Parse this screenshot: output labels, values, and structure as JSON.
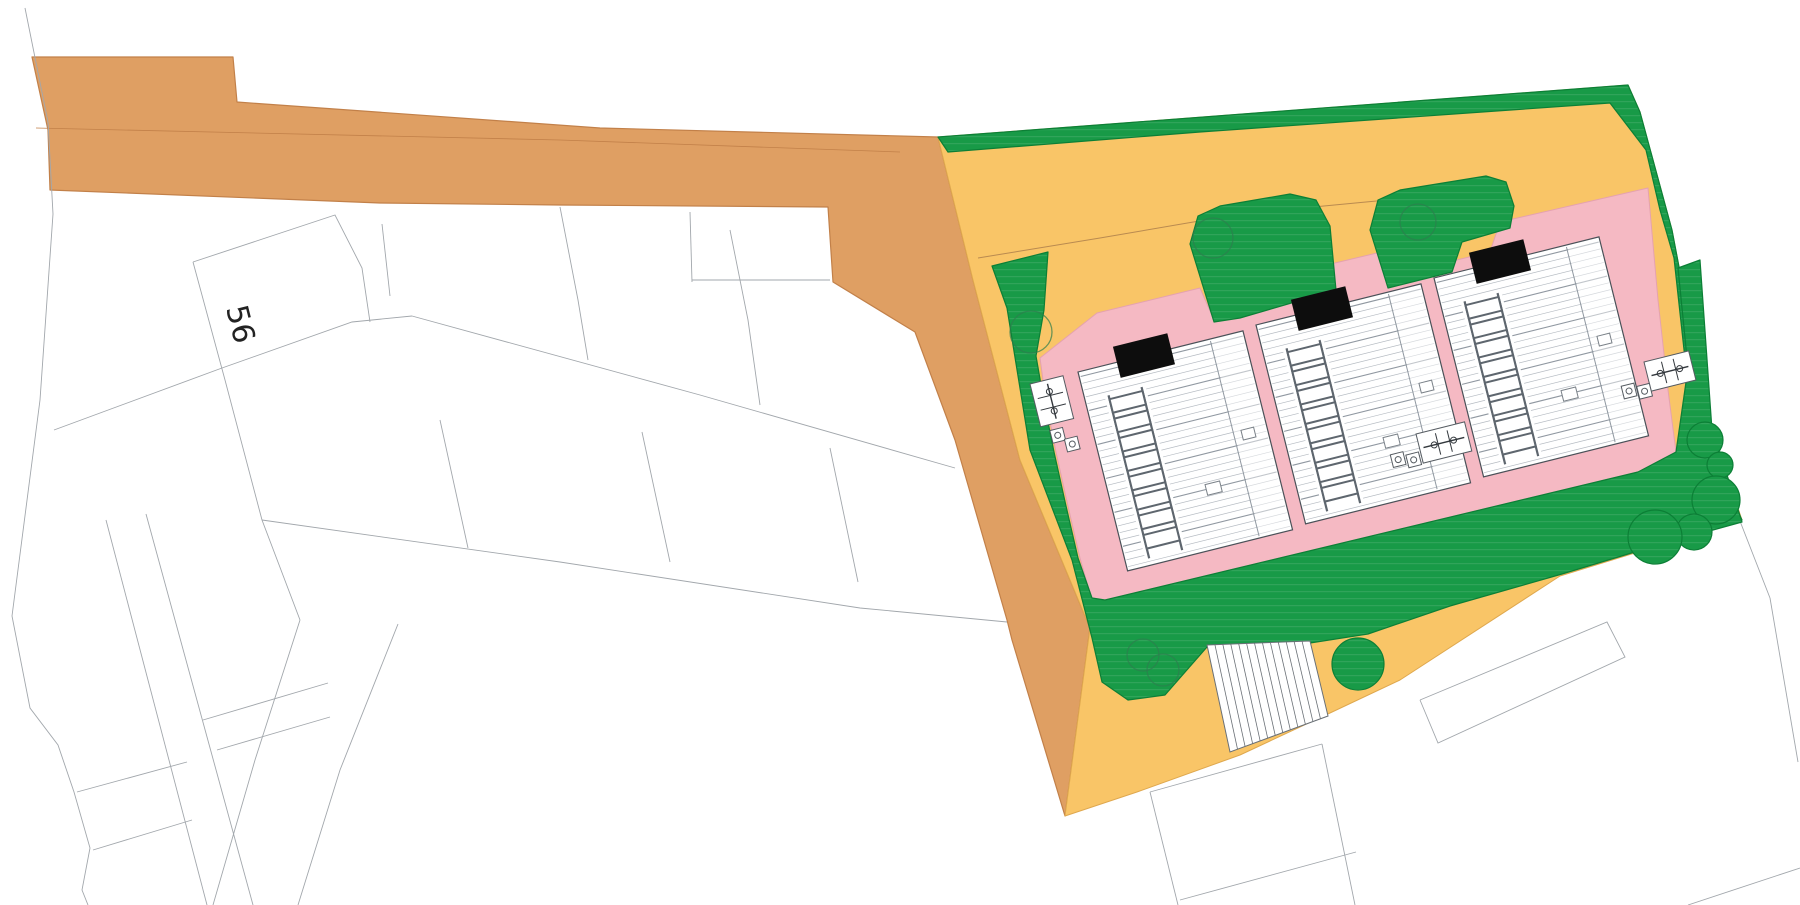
{
  "title": "architectural site plan drawing",
  "labels": {
    "plot_number": "56"
  },
  "palette": {
    "white": "#FFFFFF",
    "road": "#DF9F63",
    "road_edge": "#C28049",
    "yellow": "#F9C567",
    "yellow_edge": "#DFA84E",
    "green": "#189A47",
    "green_edge": "#0C7F36",
    "pink": "#F5B9C3",
    "pink_edge": "#E5A2AF",
    "line": "#A2A7AC",
    "black": "#0D0D0D",
    "roof_edge": "#4A5158",
    "roof_line": "#B5BBC2",
    "roof_line_dark": "#9098A1",
    "ladder": "#5E666E",
    "tree_ring": "#2E7D4F",
    "kerb": "#B98A50"
  },
  "plan": {
    "layers": [
      {
        "name": "road",
        "type": "polygon",
        "fill": "road",
        "stroke": "road_edge",
        "sw": 1.2,
        "points": [
          [
            32,
            57
          ],
          [
            233,
            57
          ],
          [
            237,
            102
          ],
          [
            600,
            128
          ],
          [
            938,
            137
          ],
          [
            973,
            280
          ],
          [
            1020,
            460
          ],
          [
            1090,
            628
          ],
          [
            1065,
            816
          ],
          [
            1012,
            640
          ],
          [
            1007,
            620
          ],
          [
            955,
            440
          ],
          [
            915,
            332
          ],
          [
            833,
            282
          ],
          [
            828,
            207
          ],
          [
            560,
            205
          ],
          [
            380,
            203
          ],
          [
            50,
            190
          ],
          [
            48,
            130
          ]
        ]
      },
      {
        "name": "road-kerb-line",
        "type": "polyline",
        "stroke": "road_edge",
        "sw": 0.8,
        "points": [
          [
            36,
            128
          ],
          [
            560,
            140
          ],
          [
            900,
            152
          ]
        ]
      },
      {
        "name": "boundary-lines",
        "type": "lines",
        "stroke": "line",
        "sw": 0.9,
        "lines": [
          [
            [
              25,
              8
            ],
            [
              48,
              122
            ],
            [
              53,
              214
            ]
          ],
          [
            [
              53,
              214
            ],
            [
              40,
              400
            ],
            [
              12,
              616
            ]
          ],
          [
            [
              12,
              616
            ],
            [
              30,
              708
            ],
            [
              58,
              745
            ],
            [
              74,
              792
            ],
            [
              90,
              848
            ],
            [
              82,
              890
            ],
            [
              88,
              905
            ]
          ],
          [
            [
              193,
              262
            ],
            [
              335,
              215
            ],
            [
              362,
              268
            ],
            [
              370,
              322
            ]
          ],
          [
            [
              222,
              368
            ],
            [
              352,
              322
            ],
            [
              412,
              316
            ]
          ],
          [
            [
              193,
              262
            ],
            [
              225,
              380
            ],
            [
              262,
              520
            ],
            [
              300,
              620
            ]
          ],
          [
            [
              412,
              316
            ],
            [
              700,
              395
            ],
            [
              955,
              468
            ]
          ],
          [
            [
              560,
              207
            ],
            [
              578,
              300
            ],
            [
              588,
              360
            ]
          ],
          [
            [
              730,
              230
            ],
            [
              748,
              320
            ],
            [
              760,
              405
            ]
          ],
          [
            [
              54,
              430
            ],
            [
              222,
              368
            ]
          ],
          [
            [
              262,
              520
            ],
            [
              560,
              562
            ],
            [
              860,
              608
            ],
            [
              1007,
              622
            ]
          ],
          [
            [
              440,
              420
            ],
            [
              468,
              548
            ]
          ],
          [
            [
              642,
              432
            ],
            [
              670,
              562
            ]
          ],
          [
            [
              830,
              448
            ],
            [
              858,
              582
            ]
          ],
          [
            [
              106,
              520
            ],
            [
              207,
              905
            ]
          ],
          [
            [
              146,
              514
            ],
            [
              253,
              905
            ]
          ],
          [
            [
              77,
              792
            ],
            [
              187,
              762
            ]
          ],
          [
            [
              93,
              850
            ],
            [
              192,
              820
            ]
          ],
          [
            [
              203,
              720
            ],
            [
              328,
              683
            ]
          ],
          [
            [
              217,
              750
            ],
            [
              330,
              717
            ]
          ],
          [
            [
              300,
              620
            ],
            [
              255,
              760
            ],
            [
              213,
              905
            ]
          ],
          [
            [
              398,
              624
            ],
            [
              340,
              770
            ],
            [
              298,
              905
            ]
          ],
          [
            [
              690,
              212
            ],
            [
              692,
              282
            ]
          ],
          [
            [
              692,
              280
            ],
            [
              830,
              280
            ]
          ],
          [
            [
              382,
              224
            ],
            [
              390,
              296
            ]
          ],
          [
            [
              1150,
              792
            ],
            [
              1178,
              905
            ]
          ],
          [
            [
              1150,
              792
            ],
            [
              1322,
              744
            ]
          ],
          [
            [
              1322,
              744
            ],
            [
              1355,
              905
            ]
          ],
          [
            [
              1180,
              900
            ],
            [
              1356,
              852
            ]
          ],
          [
            [
              1420,
              700
            ],
            [
              1607,
              622
            ],
            [
              1625,
              657
            ],
            [
              1438,
              743
            ],
            [
              1420,
              700
            ]
          ],
          [
            [
              1770,
              598
            ],
            [
              1798,
              762
            ]
          ],
          [
            [
              1738,
              516
            ],
            [
              1770,
              598
            ]
          ],
          [
            [
              1800,
              868
            ],
            [
              1688,
              905
            ]
          ]
        ]
      },
      {
        "name": "site-yellow-surface",
        "type": "polygon",
        "fill": "yellow",
        "stroke": "yellow_edge",
        "sw": 1,
        "points": [
          [
            938,
            137
          ],
          [
            1628,
            85
          ],
          [
            1640,
            112
          ],
          [
            1672,
            230
          ],
          [
            1692,
            335
          ],
          [
            1702,
            428
          ],
          [
            1726,
            472
          ],
          [
            1742,
            520
          ],
          [
            1560,
            576
          ],
          [
            1400,
            680
          ],
          [
            1330,
            713
          ],
          [
            1240,
            755
          ],
          [
            1137,
            792
          ],
          [
            1065,
            816
          ],
          [
            1090,
            628
          ],
          [
            1020,
            460
          ],
          [
            973,
            280
          ]
        ]
      },
      {
        "name": "site-kerb-line",
        "type": "polyline",
        "stroke": "kerb",
        "sw": 1,
        "points": [
          [
            978,
            258
          ],
          [
            1100,
            238
          ],
          [
            1240,
            214
          ],
          [
            1387,
            200
          ]
        ]
      },
      {
        "name": "green-boundary-strip",
        "type": "polygon",
        "fill": "GRASS",
        "stroke": "green_edge",
        "sw": 1.2,
        "points": [
          [
            938,
            137
          ],
          [
            1628,
            85
          ],
          [
            1640,
            112
          ],
          [
            1672,
            230
          ],
          [
            1692,
            335
          ],
          [
            1702,
            428
          ],
          [
            1718,
            470
          ],
          [
            1742,
            520
          ],
          [
            1700,
            472
          ],
          [
            1686,
            368
          ],
          [
            1674,
            258
          ],
          [
            1660,
            210
          ],
          [
            1646,
            150
          ],
          [
            1610,
            103
          ],
          [
            1200,
            132
          ],
          [
            948,
            152
          ]
        ]
      },
      {
        "name": "pink-paving",
        "type": "polygon",
        "fill": "pink",
        "stroke": "pink_edge",
        "sw": 1,
        "points": [
          [
            1040,
            358
          ],
          [
            1097,
            313
          ],
          [
            1200,
            288
          ],
          [
            1214,
            320
          ],
          [
            1307,
            296
          ],
          [
            1314,
            268
          ],
          [
            1398,
            248
          ],
          [
            1415,
            270
          ],
          [
            1490,
            252
          ],
          [
            1500,
            222
          ],
          [
            1648,
            188
          ],
          [
            1658,
            300
          ],
          [
            1668,
            390
          ],
          [
            1676,
            452
          ],
          [
            1638,
            472
          ],
          [
            1105,
            600
          ],
          [
            1092,
            600
          ],
          [
            1080,
            558
          ],
          [
            1068,
            506
          ],
          [
            1056,
            452
          ],
          [
            1046,
            402
          ]
        ]
      },
      {
        "name": "green-lawn",
        "type": "polygon",
        "fill": "GRASS",
        "stroke": "green_edge",
        "sw": 1.2,
        "points": [
          [
            992,
            266
          ],
          [
            1048,
            252
          ],
          [
            1044,
            310
          ],
          [
            1036,
            356
          ],
          [
            1044,
            402
          ],
          [
            1054,
            452
          ],
          [
            1066,
            506
          ],
          [
            1078,
            558
          ],
          [
            1092,
            598
          ],
          [
            1105,
            600
          ],
          [
            1638,
            472
          ],
          [
            1676,
            452
          ],
          [
            1688,
            368
          ],
          [
            1678,
            268
          ],
          [
            1700,
            260
          ],
          [
            1712,
            430
          ],
          [
            1726,
            472
          ],
          [
            1742,
            522
          ],
          [
            1648,
            548
          ],
          [
            1562,
            574
          ],
          [
            1450,
            606
          ],
          [
            1368,
            634
          ],
          [
            1310,
            643
          ],
          [
            1207,
            647
          ],
          [
            1165,
            695
          ],
          [
            1128,
            700
          ],
          [
            1102,
            682
          ],
          [
            1092,
            638
          ],
          [
            1072,
            560
          ],
          [
            1030,
            450
          ],
          [
            1007,
            308
          ]
        ]
      },
      {
        "name": "green-mound-middle",
        "type": "polygon",
        "fill": "GRASS",
        "stroke": "green_edge",
        "sw": 1.2,
        "points": [
          [
            1190,
            244
          ],
          [
            1198,
            216
          ],
          [
            1220,
            206
          ],
          [
            1290,
            194
          ],
          [
            1316,
            200
          ],
          [
            1330,
            226
          ],
          [
            1336,
            290
          ],
          [
            1240,
            318
          ],
          [
            1214,
            322
          ]
        ]
      },
      {
        "name": "green-mound-right",
        "type": "polygon",
        "fill": "GRASS",
        "stroke": "green_edge",
        "sw": 1.2,
        "points": [
          [
            1370,
            230
          ],
          [
            1378,
            200
          ],
          [
            1400,
            190
          ],
          [
            1486,
            176
          ],
          [
            1506,
            182
          ],
          [
            1514,
            206
          ],
          [
            1510,
            228
          ],
          [
            1462,
            242
          ],
          [
            1452,
            272
          ],
          [
            1388,
            288
          ]
        ]
      },
      {
        "name": "parking-court",
        "type": "parking",
        "dividers": 13,
        "corners": {
          "tl": [
            1207,
            645
          ],
          "tr": [
            1310,
            641
          ],
          "br": [
            1328,
            716
          ],
          "bl": [
            1230,
            752
          ]
        }
      },
      {
        "name": "trees",
        "type": "trees",
        "items": [
          [
            1031,
            332,
            21
          ],
          [
            1213,
            238,
            20
          ],
          [
            1418,
            222,
            18
          ],
          [
            1143,
            655,
            16
          ],
          [
            1163,
            670,
            16
          ]
        ]
      },
      {
        "name": "bushes",
        "type": "bushes",
        "items": [
          [
            1358,
            664,
            26
          ],
          [
            1705,
            440,
            18
          ],
          [
            1720,
            465,
            13
          ],
          [
            1716,
            500,
            24
          ],
          [
            1694,
            532,
            18
          ],
          [
            1655,
            537,
            27
          ]
        ]
      },
      {
        "name": "buildings",
        "type": "buildings",
        "w": 170,
        "h": 205,
        "rot": -14,
        "items": [
          [
            1078,
            372
          ],
          [
            1256,
            325
          ],
          [
            1434,
            278
          ]
        ]
      },
      {
        "name": "bike-bin-clusters",
        "type": "clusters",
        "rot": -14,
        "items": [
          {
            "x": 1030,
            "y": 384,
            "rw": 34,
            "rh": 44,
            "bins": [
              [
                8,
                50
              ],
              [
                20,
                62
              ]
            ]
          },
          {
            "x": 1416,
            "y": 434,
            "rw": 50,
            "rh": 30,
            "bins": [
              [
                -30,
                14
              ],
              [
                -15,
                18
              ]
            ]
          },
          {
            "x": 1644,
            "y": 362,
            "rw": 46,
            "rh": 30,
            "bins": [
              [
                -28,
                18
              ],
              [
                -13,
                22
              ]
            ]
          }
        ]
      },
      {
        "name": "plot-number-label",
        "type": "label",
        "ref": "plot_number",
        "x": 226,
        "y": 308,
        "rot": 76,
        "size": 30,
        "color": "#222222"
      }
    ]
  }
}
